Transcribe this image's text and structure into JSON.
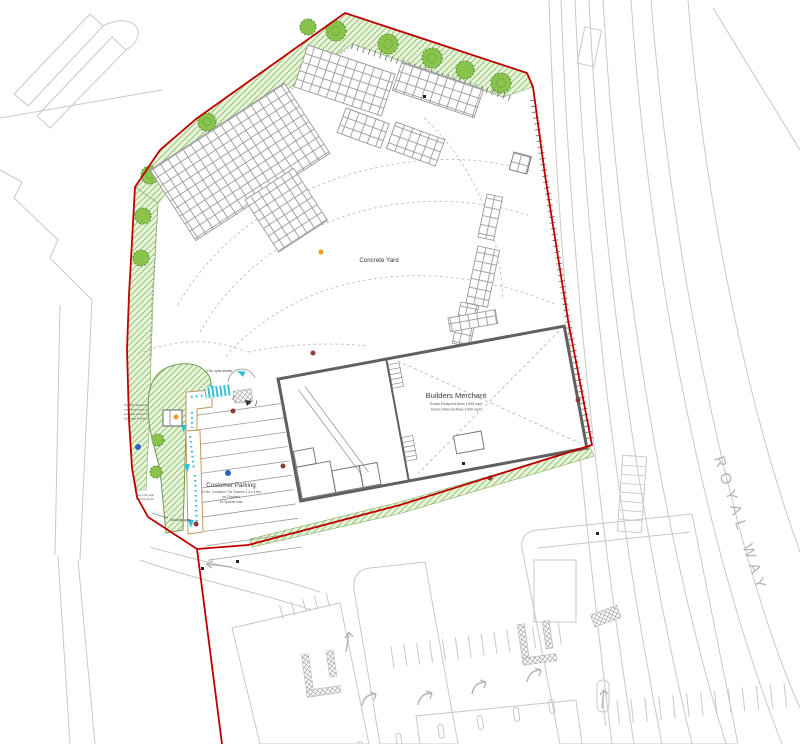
{
  "drawing": {
    "labels": {
      "concrete_yard": "Concrete Yard",
      "royal_way": "ROYAL WAY",
      "security_gate": "Security gate",
      "cycle_stands": "2 No. cycle stands",
      "fence_note_1": "New 1.8m high",
      "fence_note_2": "security fence",
      "kiosk_note_1": "Possible Electricity",
      "kiosk_note_2": "meter kiosk location in",
      "kiosk_note_3": "accessible location by",
      "kiosk_note_4": "Gateway Provider"
    },
    "building": {
      "name": "Builders Merchant",
      "area_line1": "Gross Footprint Area 1495 sqm",
      "area_line2": "Gross Internal Area 1490 sqm"
    },
    "parking": {
      "name": "Customer Parking",
      "detail_line1": "14 No. Customer Car Spaces 2.4 x 4.8m",
      "detail_line2": "Inc Disabled",
      "detail_line3": "16 Spaces total"
    },
    "colors": {
      "boundary_red": "#c00000",
      "landscape_green": "#8ac34a",
      "context_gray": "#c8c8c8",
      "pedestrian_cyan": "#35bcd8",
      "building_gray": "#606060"
    }
  }
}
